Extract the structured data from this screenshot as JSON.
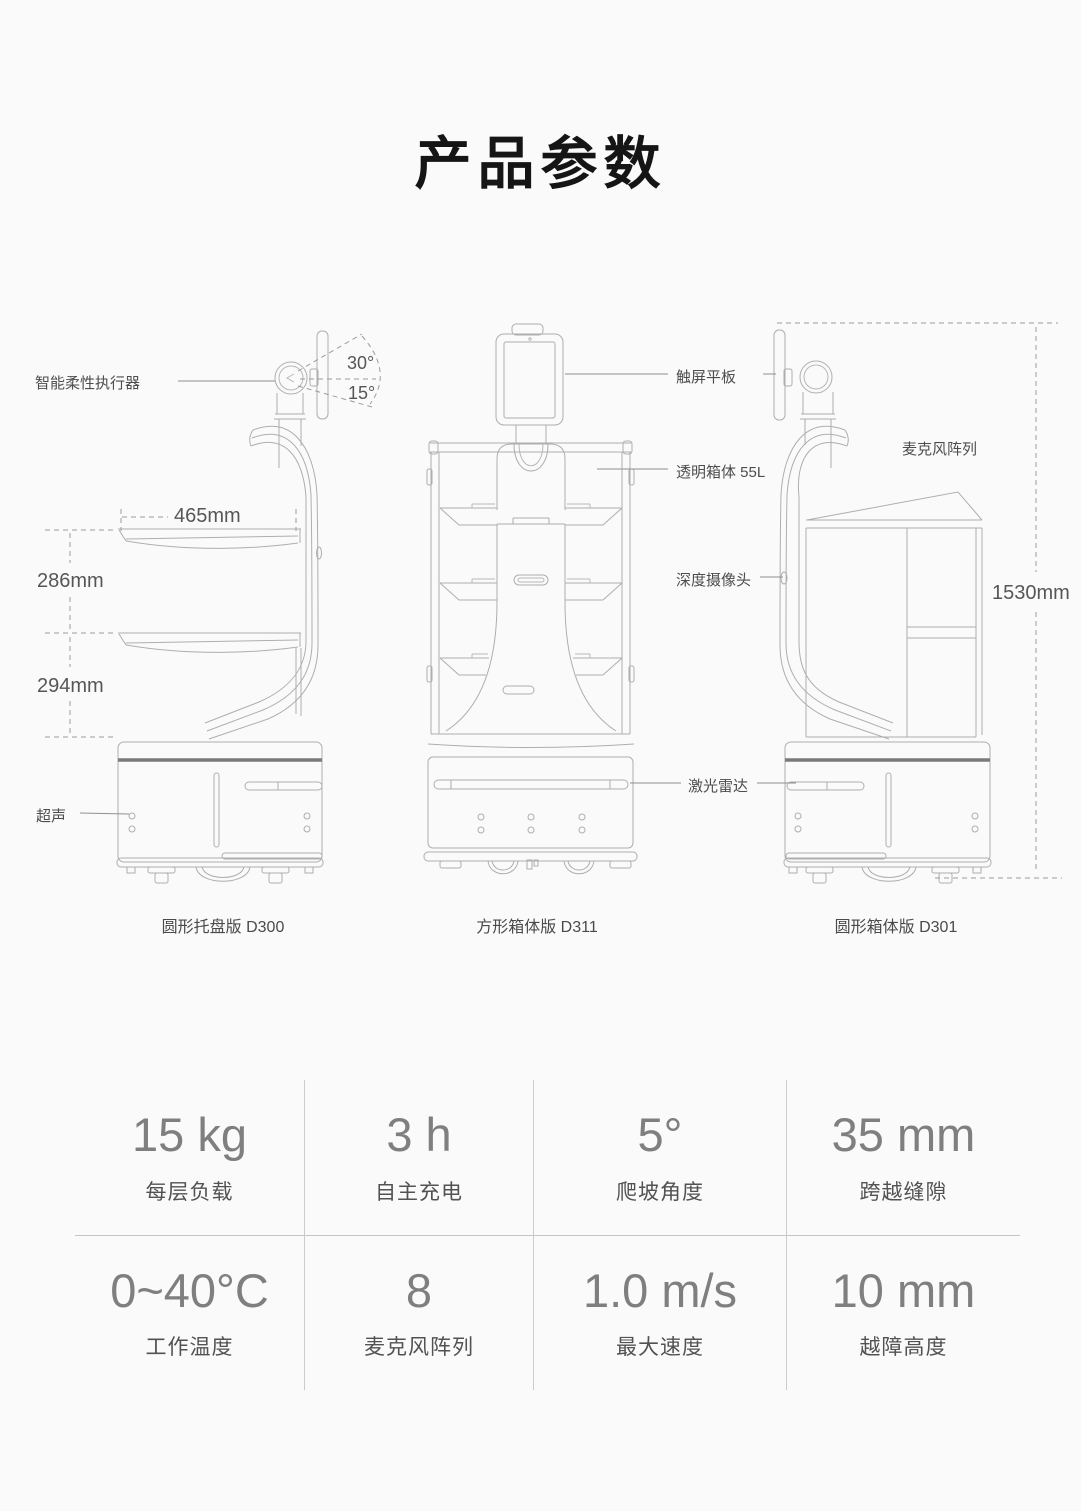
{
  "page": {
    "title": "产品参数",
    "background": "#fafafa"
  },
  "diagram": {
    "robots": [
      {
        "id": "d300",
        "caption": "圆形托盘版 D300"
      },
      {
        "id": "d311",
        "caption": "方形箱体版 D311"
      },
      {
        "id": "d301",
        "caption": "圆形箱体版 D301"
      }
    ],
    "callouts": {
      "actuator": "智能柔性执行器",
      "angle_up": "30°",
      "angle_down": "15°",
      "ultrasonic": "超声",
      "touchscreen": "触屏平板",
      "box": "透明箱体 55L",
      "depth_camera": "深度摄像头",
      "lidar": "激光雷达",
      "mic_array": "麦克风阵列"
    },
    "dimensions": {
      "tray_width": "465mm",
      "tray_gap_upper": "286mm",
      "tray_gap_lower": "294mm",
      "total_height": "1530mm"
    },
    "line_color": "#aeaeae"
  },
  "specs": {
    "rows": [
      [
        {
          "value": "15 kg",
          "label": "每层负载"
        },
        {
          "value": "3 h",
          "label": "自主充电"
        },
        {
          "value": "5°",
          "label": "爬坡角度"
        },
        {
          "value": "35 mm",
          "label": "跨越缝隙"
        }
      ],
      [
        {
          "value": "0~40°C",
          "label": "工作温度"
        },
        {
          "value": "8",
          "label": "麦克风阵列"
        },
        {
          "value": "1.0 m/s",
          "label": "最大速度"
        },
        {
          "value": "10 mm",
          "label": "越障高度"
        }
      ]
    ]
  }
}
